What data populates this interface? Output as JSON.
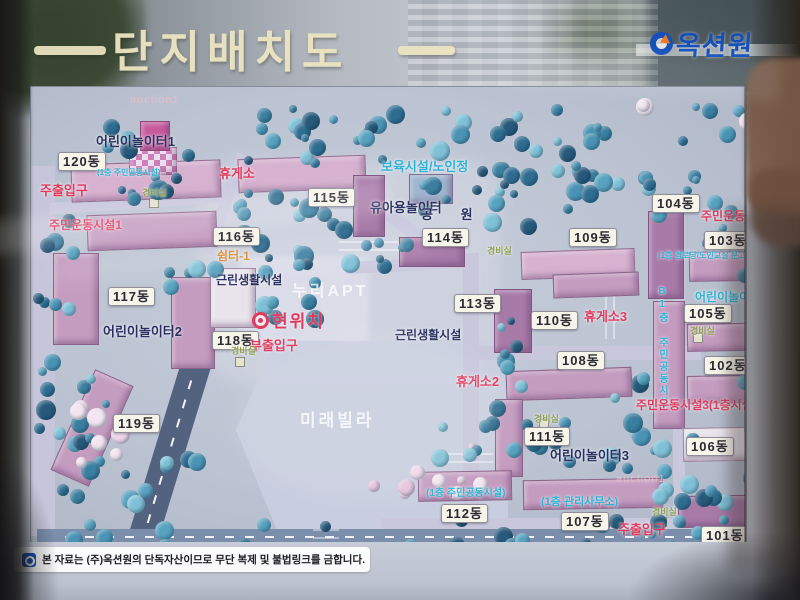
{
  "header": {
    "title": "단지배치도",
    "logo_text": "옥션원"
  },
  "footer": {
    "disclaimer": "본 자료는 (주)옥션원의 단독자산이므로 무단 복제 및 불법링크를 금합니다."
  },
  "colors": {
    "title_cream": "#ece5c2",
    "logo_blue": "#1550b8",
    "label_red": "#e23a5e",
    "label_navy": "#2a3060",
    "label_cyan": "#2fb3d4",
    "label_orange": "#d8882f",
    "label_green": "#8fa055",
    "building_pink": "#c49cc0",
    "tree_teal": "#4a93b4"
  },
  "map": {
    "current_location": {
      "text": "현위치",
      "x": 271,
      "y": 306,
      "dot_x": 251,
      "dot_y": 311
    },
    "building_labels": [
      {
        "text": "120동",
        "x": 57,
        "y": 151
      },
      {
        "text": "116동",
        "x": 212,
        "y": 226
      },
      {
        "text": "115동",
        "x": 307,
        "y": 187
      },
      {
        "text": "114동",
        "x": 421,
        "y": 227
      },
      {
        "text": "113동",
        "x": 453,
        "y": 293
      },
      {
        "text": "110동",
        "x": 530,
        "y": 310
      },
      {
        "text": "109동",
        "x": 568,
        "y": 227
      },
      {
        "text": "108동",
        "x": 556,
        "y": 350
      },
      {
        "text": "104동",
        "x": 651,
        "y": 193
      },
      {
        "text": "103동",
        "x": 703,
        "y": 230
      },
      {
        "text": "105동",
        "x": 683,
        "y": 303
      },
      {
        "text": "102동",
        "x": 703,
        "y": 355
      },
      {
        "text": "106동",
        "x": 685,
        "y": 436
      },
      {
        "text": "111동",
        "x": 523,
        "y": 426
      },
      {
        "text": "117동",
        "x": 107,
        "y": 286
      },
      {
        "text": "118동",
        "x": 211,
        "y": 330
      },
      {
        "text": "119동",
        "x": 112,
        "y": 413
      },
      {
        "text": "112동",
        "x": 440,
        "y": 503
      },
      {
        "text": "107동",
        "x": 560,
        "y": 511
      },
      {
        "text": "101동",
        "x": 700,
        "y": 525
      }
    ],
    "poi_labels": [
      {
        "text": "어린이놀이터1",
        "x": 95,
        "y": 134,
        "cls": "navy",
        "fs": 13
      },
      {
        "text": "휴게소",
        "x": 218,
        "y": 166,
        "cls": "red",
        "fs": 13
      },
      {
        "text": "주출입구",
        "x": 39,
        "y": 183,
        "cls": "red",
        "fs": 13
      },
      {
        "text": "(1층 주민공동시설)",
        "x": 96,
        "y": 168,
        "cls": "cyan",
        "fs": 8
      },
      {
        "text": "경비실",
        "x": 141,
        "y": 188,
        "cls": "green",
        "fs": 9
      },
      {
        "text": "주민운동시설1",
        "x": 48,
        "y": 218,
        "cls": "red",
        "fs": 12
      },
      {
        "text": "보육시설/노인정",
        "x": 380,
        "y": 159,
        "cls": "cyan",
        "fs": 13
      },
      {
        "text": "유아용놀이터",
        "x": 369,
        "y": 200,
        "cls": "navy",
        "fs": 13
      },
      {
        "text": "공 원",
        "x": 420,
        "y": 207,
        "cls": "navy",
        "fs": 13,
        "ls": 12
      },
      {
        "text": "쉼터-1",
        "x": 216,
        "y": 249,
        "cls": "orange",
        "fs": 12
      },
      {
        "text": "근린생활시설",
        "x": 215,
        "y": 273,
        "cls": "navy",
        "fs": 12
      },
      {
        "text": "경비실",
        "x": 486,
        "y": 246,
        "cls": "green",
        "fs": 9
      },
      {
        "text": "근린생활시설",
        "x": 394,
        "y": 328,
        "cls": "navy",
        "fs": 12
      },
      {
        "text": "부출입구",
        "x": 249,
        "y": 338,
        "cls": "red",
        "fs": 13
      },
      {
        "text": "경비실",
        "x": 230,
        "y": 346,
        "cls": "green",
        "fs": 9
      },
      {
        "text": "어린이놀이터2",
        "x": 102,
        "y": 324,
        "cls": "navy",
        "fs": 13
      },
      {
        "text": "휴게소2",
        "x": 455,
        "y": 374,
        "cls": "red",
        "fs": 13
      },
      {
        "text": "휴게소3",
        "x": 583,
        "y": 309,
        "cls": "red",
        "fs": 13
      },
      {
        "text": "주민운동시설2",
        "x": 700,
        "y": 209,
        "cls": "red",
        "fs": 12
      },
      {
        "text": "(1층 경로당/노인교실 문고시설)",
        "x": 657,
        "y": 251,
        "cls": "cyan",
        "fs": 8
      },
      {
        "text": "어린이놀이터4",
        "x": 694,
        "y": 290,
        "cls": "cyan",
        "fs": 12
      },
      {
        "text": "경비실",
        "x": 689,
        "y": 326,
        "cls": "green",
        "fs": 9
      },
      {
        "text": "B1층 주민공동시설",
        "x": 655,
        "y": 285,
        "cls": "cyan",
        "fs": 10,
        "vert": true
      },
      {
        "text": "주민운동시설3(1층시설)",
        "x": 635,
        "y": 398,
        "cls": "red",
        "fs": 12
      },
      {
        "text": "경비실",
        "x": 533,
        "y": 414,
        "cls": "green",
        "fs": 9
      },
      {
        "text": "어린이놀이터3",
        "x": 549,
        "y": 448,
        "cls": "navy",
        "fs": 13
      },
      {
        "text": "(1층 주민공동시설)",
        "x": 425,
        "y": 488,
        "cls": "cyan",
        "fs": 10
      },
      {
        "text": "(1층 관리사무소)",
        "x": 540,
        "y": 496,
        "cls": "cyan",
        "fs": 11
      },
      {
        "text": "주출입구",
        "x": 617,
        "y": 522,
        "cls": "red",
        "fs": 13
      },
      {
        "text": "경비실",
        "x": 651,
        "y": 507,
        "cls": "green",
        "fs": 9
      }
    ],
    "watermarks": [
      {
        "text": "누리APT",
        "x": 291,
        "y": 283,
        "fs": 16,
        "cls": "wm"
      },
      {
        "text": "미래빌라",
        "x": 299,
        "y": 411,
        "fs": 17,
        "cls": "wm"
      },
      {
        "text": "auction1",
        "x": 129,
        "y": 94,
        "fs": 11,
        "cls": "wm2"
      },
      {
        "text": "auction1",
        "x": 615,
        "y": 473,
        "fs": 11,
        "cls": "wm2"
      }
    ]
  }
}
